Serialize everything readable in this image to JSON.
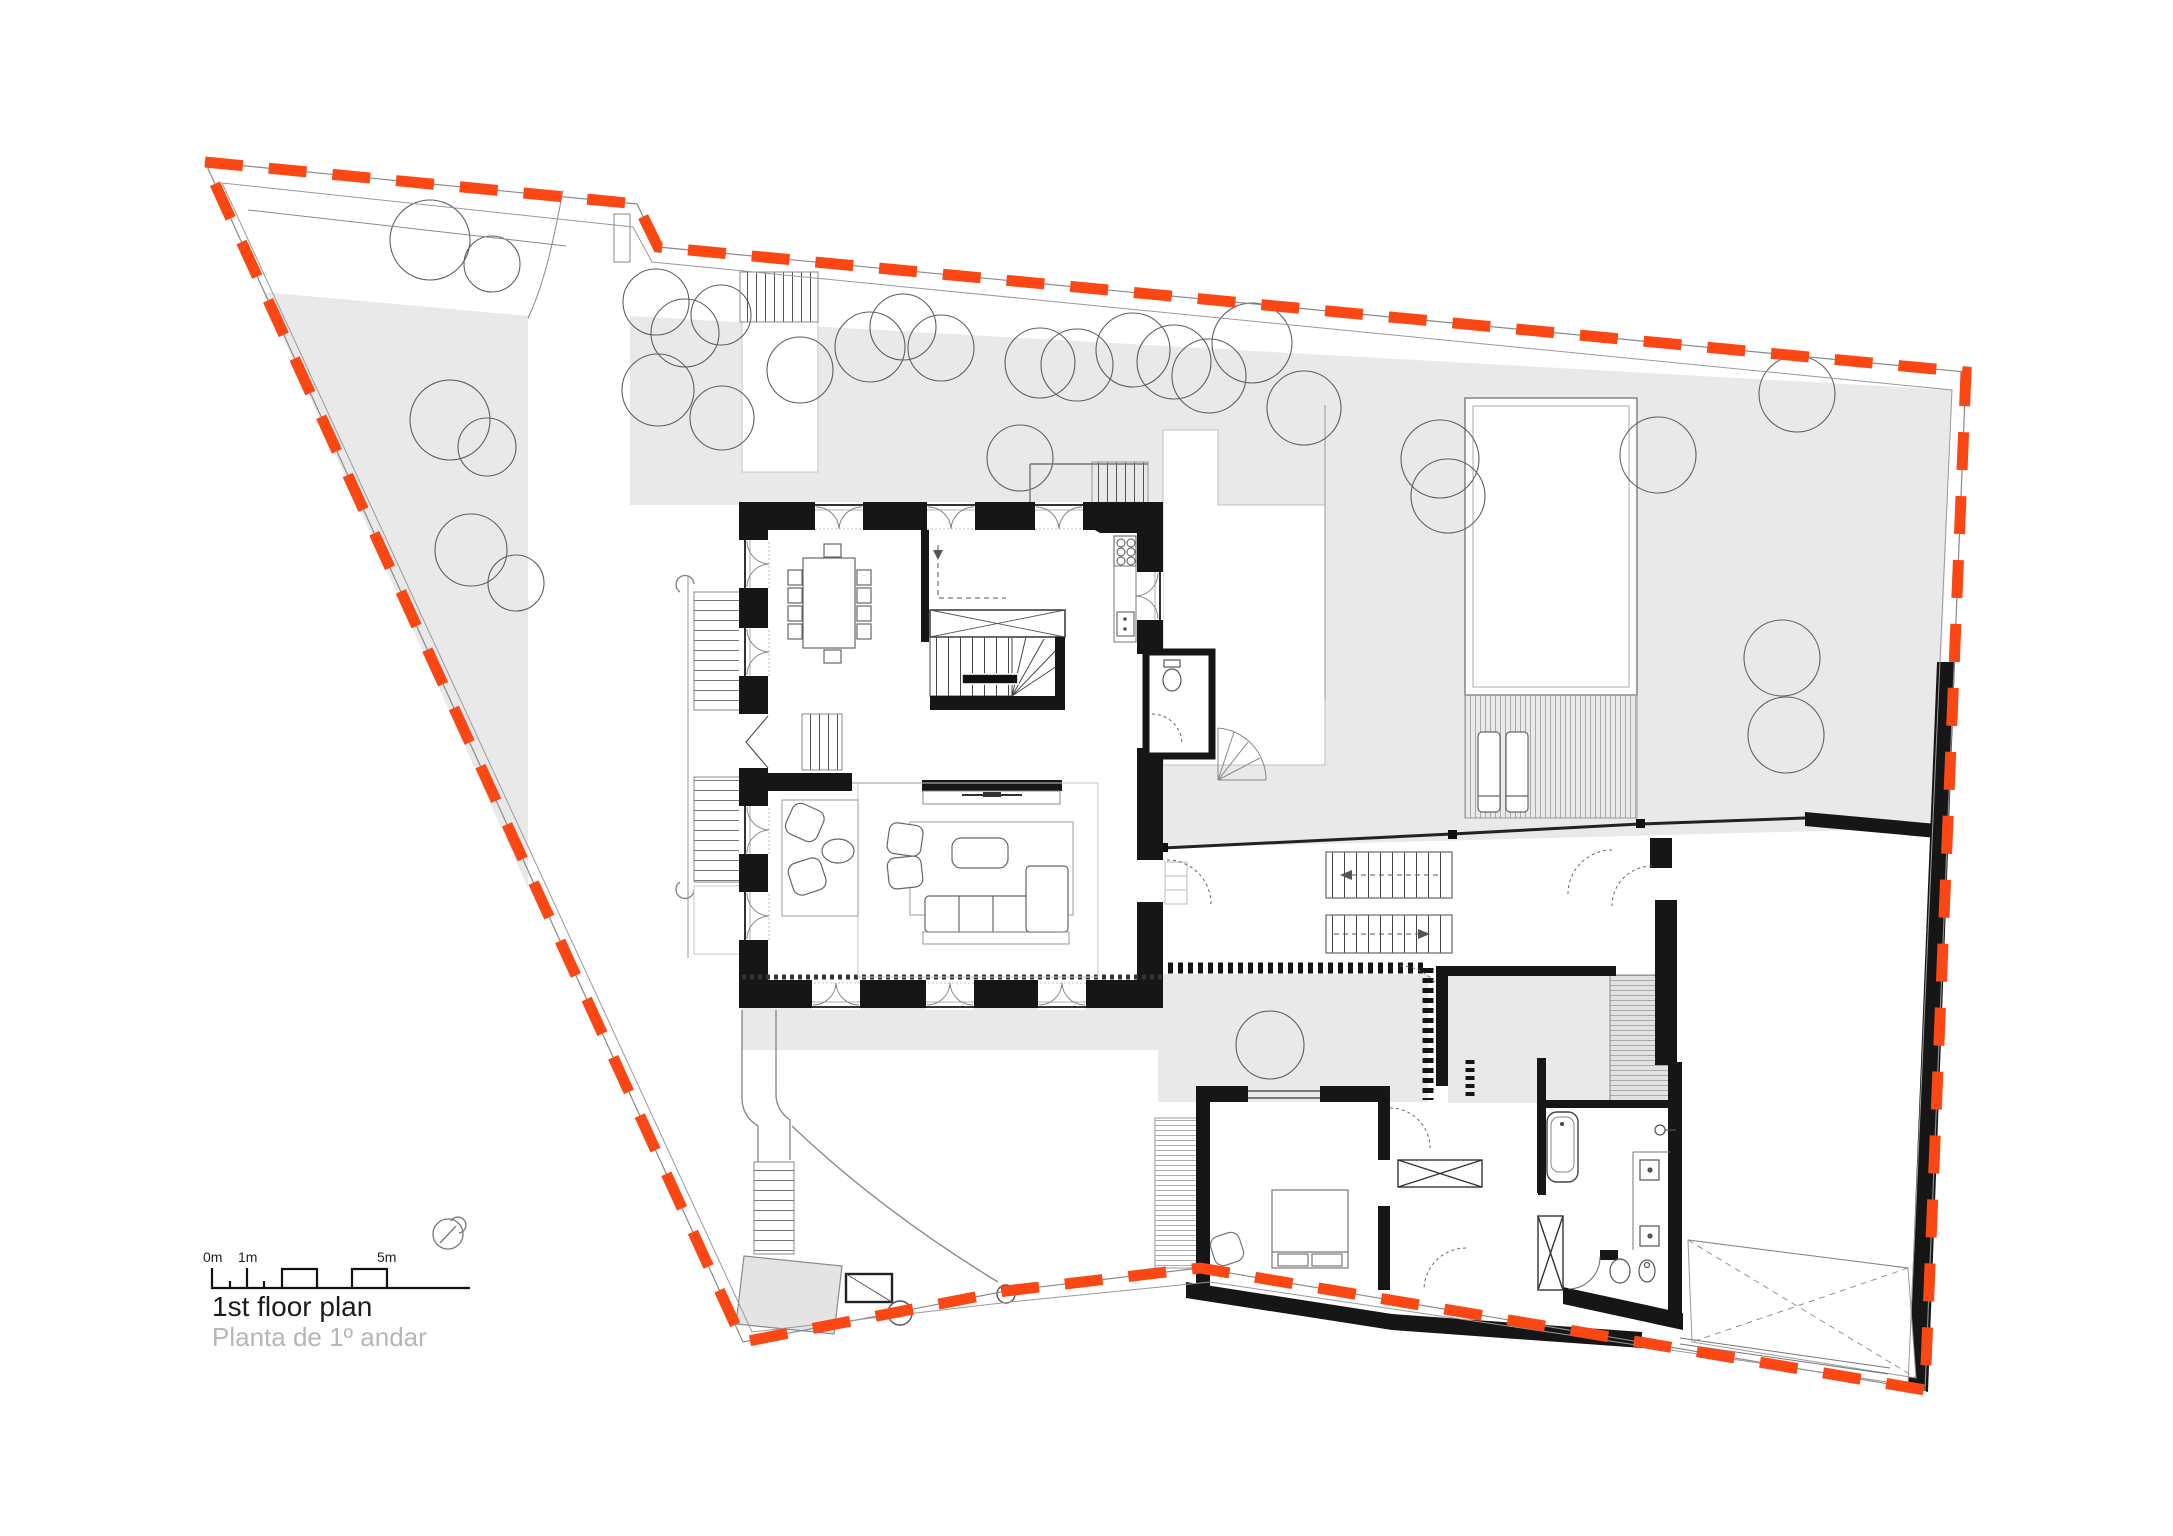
{
  "page": {
    "kind": "architectural floor plan drawing",
    "background": "#ffffff",
    "width_px": 2173,
    "height_px": 1536
  },
  "title_block": {
    "title": "1st floor plan",
    "subtitle": "Planta de 1º andar"
  },
  "scale_bar": {
    "zero_label": "0m",
    "one_label": "1m",
    "five_label": "5m",
    "raised_segments_m": [
      [
        2,
        3
      ],
      [
        4,
        5
      ]
    ]
  },
  "north_indicator": {
    "icon": "compass-circle-icon"
  },
  "colors": {
    "boundary_dash": "#fa4713",
    "survey_line": "#8a8a8a",
    "site_fill": "#e9e9e9",
    "wall_fill": "#161616",
    "tree_stroke": "#5f5f5f",
    "furniture_stroke": "#666666",
    "title_text": "#1b1b1b",
    "subtitle_text": "#b4b6b8"
  },
  "site_features": [
    "dashed-property-boundary",
    "garden-areas",
    "tree-canopies",
    "driveway",
    "street-access-stairs",
    "swimming-pool",
    "pool-deck-with-loungers",
    "garden-gate-posts",
    "garden-shed",
    "ramp-with-x-marking"
  ],
  "building_features": [
    "dining-room-with-table",
    "kitchen-with-hob-and-sink",
    "winder-staircase",
    "living-room-with-sofas-and-tv",
    "entry-porch",
    "wc",
    "exterior-side-stairs",
    "bedroom-with-bed",
    "corridor-closets",
    "bathroom-with-tub-toilet-bidet-sinks",
    "dressing-area",
    "terrace-decks"
  ]
}
